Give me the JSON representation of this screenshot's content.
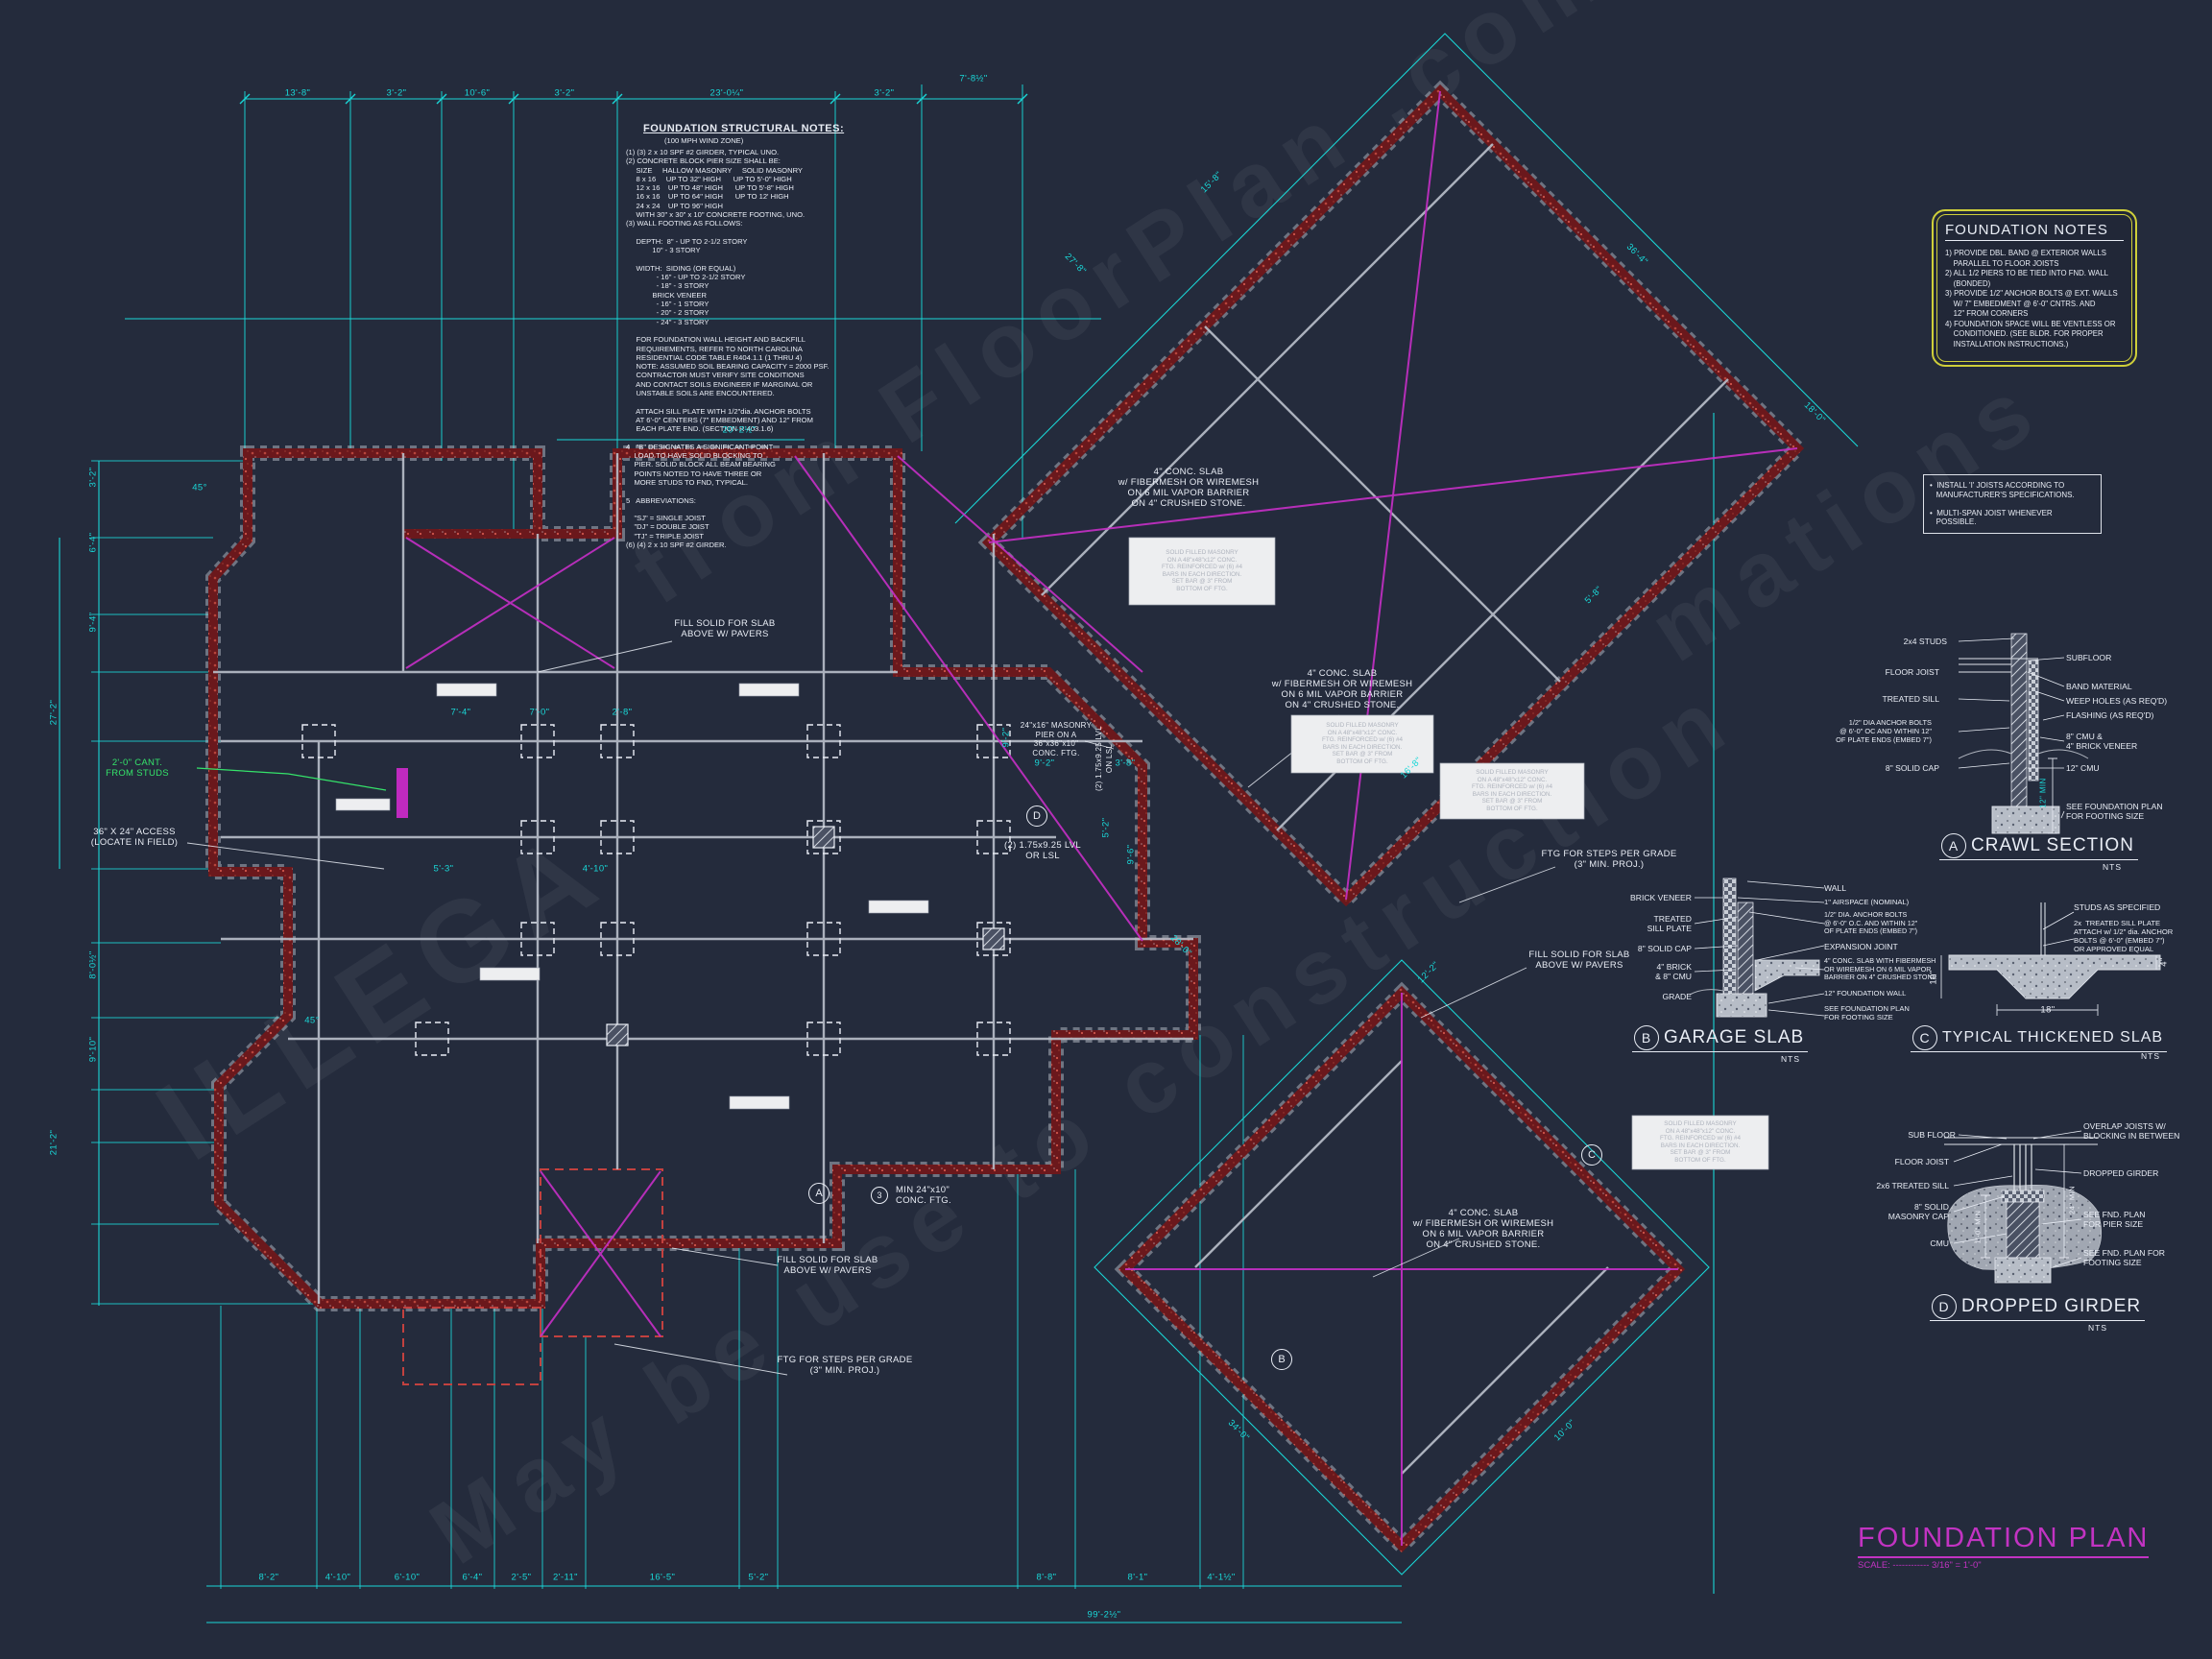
{
  "colors": {
    "background": "#242b3c",
    "cyan_dimension": "#1ad7d7",
    "wall_red": "#6b181c",
    "magenta_brace": "#c62fc6",
    "annotation_white": "#e9edf5",
    "green_note": "#35e36a",
    "notes_box_yellow": "#cfcf3a",
    "title_magenta": "#c233c2"
  },
  "structural_notes": {
    "title": "FOUNDATION STRUCTURAL NOTES:",
    "subtitle": "(100 MPH WIND ZONE)",
    "body": "(1) (3) 2 x 10 SPF #2 GIRDER, TYPICAL UNO.\n(2) CONCRETE BLOCK PIER SIZE SHALL BE:\n     SIZE     HALLOW MASONRY     SOLID MASONRY\n     8 x 16     UP TO 32\" HIGH      UP TO 5'-0\" HIGH\n     12 x 16    UP TO 48\" HIGH      UP TO 5'-8\" HIGH\n     16 x 16    UP TO 64\" HIGH      UP TO 12' HIGH\n     24 x 24    UP TO 96\" HIGH\n     WITH 30\" x 30\" x 10\" CONCRETE FOOTING, UNO.\n(3) WALL FOOTING AS FOLLOWS:\n\n     DEPTH:  8\" - UP TO 2-1/2 STORY\n             10\" - 3 STORY\n\n     WIDTH:  SIDING (OR EQUAL)\n               - 16\" - UP TO 2-1/2 STORY\n               - 18\" - 3 STORY\n             BRICK VENEER\n               - 16\" - 1 STORY\n               - 20\" - 2 STORY\n               - 24\" - 3 STORY\n\n     FOR FOUNDATION WALL HEIGHT AND BACKFILL\n     REQUIREMENTS, REFER TO NORTH CAROLINA\n     RESIDENTIAL CODE TABLE R404.1.1 (1 THRU 4)\n     NOTE: ASSUMED SOIL BEARING CAPACITY = 2000 PSF.\n     CONTRACTOR MUST VERIFY SITE CONDITIONS\n     AND CONTACT SOILS ENGINEER IF MARGINAL OR\n     UNSTABLE SOILS ARE ENCOUNTERED.\n\n     ATTACH SILL PLATE WITH 1/2\"dia. ANCHOR BOLTS\n     AT 6'-0\" CENTERS (7\" EMBEDMENT) AND 12\" FROM\n     EACH PLATE END. (SECTION R 403.1.6)\n\n4   \"B\" DESIGNATES A SIGNIFICANT POINT\n    LOAD TO HAVE SOLID BLOCKING TO\n    PIER. SOLID BLOCK ALL BEAM BEARING\n    POINTS NOTED TO HAVE THREE OR\n    MORE STUDS TO FND, TYPICAL.\n\n5   ABBREVIATIONS:\n\n    \"SJ\" = SINGLE JOIST\n    \"DJ\" = DOUBLE JOIST\n    \"TJ\" = TRIPLE JOIST\n(6) (4) 2 x 10 SPF #2 GIRDER."
  },
  "foundation_notes": {
    "title": "FOUNDATION NOTES",
    "body": "1) PROVIDE DBL. BAND @ EXTERIOR WALLS\n    PARALLEL TO FLOOR JOISTS\n2) ALL 1/2 PIERS TO BE TIED INTO FND. WALL\n    (BONDED)\n3) PROVIDE 1/2\" ANCHOR BOLTS @ EXT. WALLS\n    W/ 7\" EMBEDMENT @ 6'-0\" CNTRS. AND\n    12\" FROM CORNERS\n4) FOUNDATION SPACE WILL BE VENTLESS OR\n    CONDITIONED. (SEE BLDR. FOR PROPER\n    INSTALLATION INSTRUCTIONS.)"
  },
  "ijoist_box": {
    "body": "•  INSTALL 'I' JOISTS ACCORDING TO\n   MANUFACTURER'S SPECIFICATIONS.\n\n•  MULTI-SPAN JOIST WHENEVER\n   POSSIBLE."
  },
  "title_block": {
    "title": "FOUNDATION PLAN",
    "scale": "SCALE: ------------ 3/16\" = 1'-0\""
  },
  "details": {
    "crawl": {
      "letter": "A",
      "title": "CRAWL SECTION",
      "scale": "NTS",
      "left": [
        "2x4 STUDS",
        "FLOOR JOIST",
        "TREATED SILL",
        "1/2\" DIA ANCHOR BOLTS\n@ 6'-0\" OC AND WITHIN 12\"\nOF PLATE ENDS (EMBED 7\")",
        "8\" SOLID CAP"
      ],
      "right": [
        "SUBFLOOR",
        "BAND MATERIAL",
        "WEEP HOLES (AS REQ'D)",
        "FLASHING (AS REQ'D)",
        "8\" CMU &\n4\" BRICK VENEER",
        "12\" CMU",
        "SEE FOUNDATION PLAN\nFOR FOOTING SIZE"
      ],
      "dim": "12\" MIN"
    },
    "garage": {
      "letter": "B",
      "title": "GARAGE SLAB",
      "scale": "NTS",
      "left": [
        "BRICK VENEER",
        "TREATED\nSILL PLATE",
        "8\" SOLID CAP",
        "4\" BRICK\n& 8\" CMU",
        "GRADE"
      ],
      "right": [
        "WALL",
        "1\" AIRSPACE (NOMINAL)",
        "1/2\" DIA. ANCHOR BOLTS\n@ 6'-0\" O.C. AND WITHIN 12\"\nOF PLATE ENDS (EMBED 7\")",
        "EXPANSION JOINT",
        "4\" CONC. SLAB WITH FIBERMESH\nOR WIREMESH ON 6 MIL VAPOR\nBARRIER ON 4\" CRUSHED STONE",
        "12\" FOUNDATION WALL",
        "SEE FOUNDATION PLAN\nFOR FOOTING SIZE"
      ]
    },
    "thickened": {
      "letter": "C",
      "title": "TYPICAL THICKENED SLAB",
      "scale": "NTS",
      "labels": [
        "STUDS AS SPECIFIED",
        "2x  TREATED SILL PLATE\nATTACH w/ 1/2\" dia. ANCHOR\nBOLTS @ 6'-0\" (EMBED 7\")\nOR APPROVED EQUAL"
      ],
      "dims": [
        "18\"",
        "10\"",
        "4\""
      ]
    },
    "dropped": {
      "letter": "D",
      "title": "DROPPED GIRDER",
      "scale": "NTS",
      "left": [
        "SUB FLOOR",
        "FLOOR JOIST",
        "2x6 TREATED SILL",
        "8\" SOLID\nMASONRY CAP",
        "CMU"
      ],
      "right": [
        "OVERLAP JOISTS W/\nBLOCKING IN BETWEEN",
        "DROPPED GIRDER",
        "SEE FND. PLAN\nFOR PIER SIZE",
        "SEE FND. PLAN FOR\nFOOTING SIZE"
      ],
      "dims": [
        "1'-0\" MIN",
        "24\" MIN"
      ]
    }
  },
  "plan": {
    "annotations": {
      "fill_solid": "FILL SOLID FOR SLAB\nABOVE W/ PAVERS",
      "conc_slab": "4\" CONC. SLAB\nw/ FIBERMESH OR WIREMESH\nON 6 MIL VAPOR BARRIER\nON 4\" CRUSHED STONE.",
      "ftg_steps": "FTG FOR STEPS PER GRADE\n(3\" MIN. PROJ.)",
      "access": "36\" X 24\" ACCESS\n(LOCATE IN FIELD)",
      "cant": "2'-0\" CANT.\nFROM STUDS",
      "masonry_pier": "24\"x16\" MASONRY\nPIER ON A\n36\"x36\"x10\"\nCONC. FTG.",
      "lvl": "(2) 1.75x9.25 LVL\nOR LSL",
      "lvl_vert": "(2) 1.75x9.25 LVL\nON LSL",
      "min_ftg": "MIN 24\"x10\"\nCONC. FTG.",
      "solid_masonry": "SOLID FILLED MASONRY\nON A 48\"x48\"x12\" CONC.\nFTG. REINFORCED w/ (6) #4\nBARS IN EACH DIRECTION.\nSET BAR @ 3\" FROM\nBOTTOM OF FTG.",
      "marker_a": "A",
      "marker_b": "B",
      "marker_c": "C",
      "marker_d": "D",
      "hex3": "3"
    },
    "dims": {
      "top": [
        "13'-8\"",
        "3'-2\"",
        "10'-6\"",
        "3'-2\"",
        "23'-0¼\"",
        "3'-2\"",
        "7'-8½\""
      ],
      "left": [
        "3'-2\"",
        "6'-4\"",
        "9'-4\"",
        "27'-2\"",
        "8'-0½\"",
        "9'-10\"",
        "21'-2\""
      ],
      "bottom": [
        "8'-2\"",
        "4'-10\"",
        "6'-10\"",
        "6'-4\"",
        "2'-5\"",
        "2'-11\"",
        "16'-5\"",
        "5'-2\"",
        "8'-8\"",
        "8'-1\"",
        "4'-1½\""
      ],
      "bottom_total": "99'-2½\"",
      "diag": [
        "15'-8\"",
        "27'-8\"",
        "36'-4\"",
        "18'-0\"",
        "5'-8\"",
        "16'-8\"",
        "28'-0\"",
        "12'-2\"",
        "34'-0\"",
        "10'-0\""
      ],
      "interior": [
        "9'-2\"",
        "3'-8\"",
        "9'-2\"",
        "5'-2\"",
        "9'-6\"",
        "7'-4\"",
        "7'-0\"",
        "2'-8\"",
        "5'-3\"",
        "4'-10\"",
        "20'-2½\"",
        "45°",
        "45°"
      ]
    }
  },
  "watermark": {
    "lines": [
      "ILLEGA",
      "from FloorPlan .com",
      "May be use to construction",
      "mations"
    ]
  }
}
